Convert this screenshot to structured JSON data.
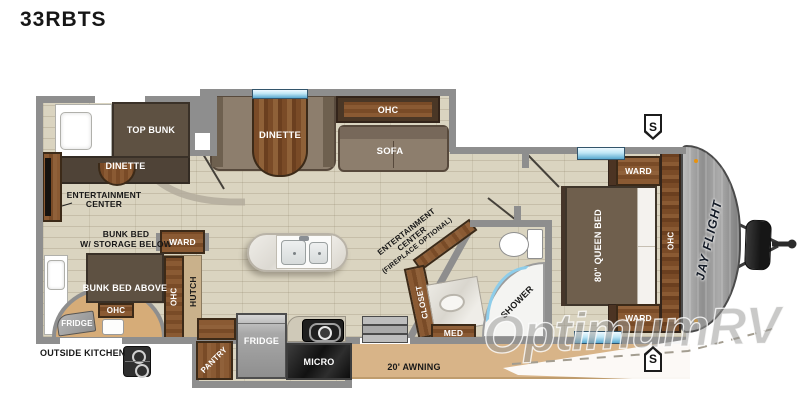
{
  "title": "33RBTS",
  "watermark": "OptimumRV",
  "plan": {
    "bunk_room": {
      "top_bunk": "TOP BUNK",
      "dinette": "DINETTE",
      "ent_center_line1": "ENTERTAINMENT",
      "ent_center_line2": "CENTER",
      "bunk_bed_line1": "BUNK BED",
      "bunk_bed_line2": "W/ STORAGE BELOW",
      "bunk_bed_above": "BUNK BED ABOVE",
      "ohc": "OHC",
      "fridge": "FRIDGE",
      "outside_kitchen": "OUTSIDE KITCHEN"
    },
    "living": {
      "dinette": "DINETTE",
      "ohc": "OHC",
      "sofa": "SOFA",
      "ward": "WARD",
      "hutch_ohc": "OHC",
      "hutch": "HUTCH"
    },
    "kitchen": {
      "pantry": "PANTRY",
      "fridge": "FRIDGE",
      "micro": "MICRO",
      "awning": "20' AWNING"
    },
    "bath": {
      "ent_line1": "ENTERTAINMENT",
      "ent_line2": "CENTER",
      "ent_line3": "(FIREPLACE OPTIONAL)",
      "closet": "CLOSET",
      "med": "MED",
      "shower": "SHOWER"
    },
    "bedroom": {
      "bed": "80\" QUEEN BED",
      "ward_top": "WARD",
      "ward_bottom": "WARD",
      "ohc": "OHC"
    },
    "exterior": {
      "logo": "JAY FLIGHT",
      "speaker_top": "S",
      "speaker_bottom": "S"
    },
    "colors": {
      "wall": "#8e8e8e",
      "floor": "#dad4c0",
      "wood": "#8a5a33",
      "furniture_brown": "#5e5142",
      "cushion_taupe": "#8d7e6d",
      "awning_tan": "#d8b488",
      "window_blue": "#9fd2ec",
      "appliance_black": "#1e1e1e"
    }
  }
}
